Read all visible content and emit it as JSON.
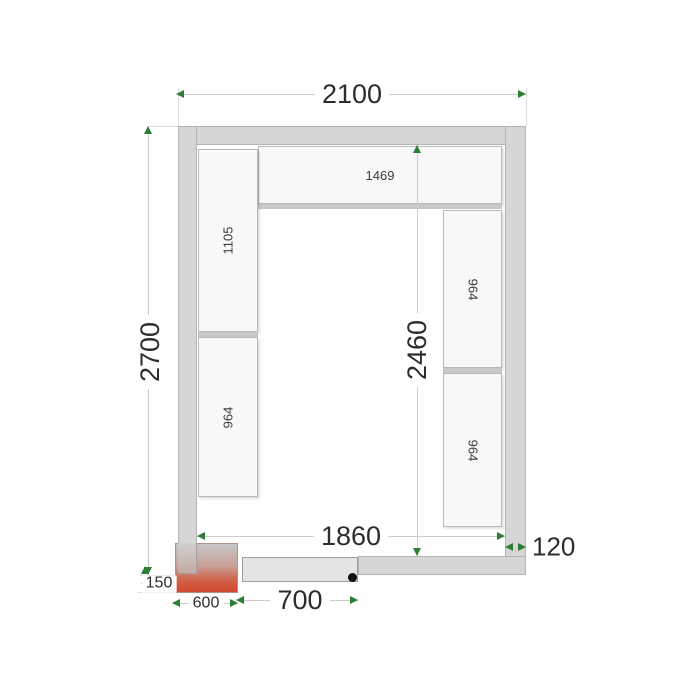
{
  "plan": {
    "dimensions": {
      "outer_width": "2100",
      "outer_height": "2700",
      "inner_width": "1860",
      "inner_height": "2460",
      "wall_thickness": "120",
      "door_width": "700",
      "cooling_unit_width": "600",
      "cooling_unit_offset": "150"
    },
    "shelves": {
      "top": "1469",
      "left_upper": "1105",
      "left_lower": "964",
      "right_upper": "964",
      "right_lower": "964"
    },
    "colors": {
      "wall_fill": "#d6d6d6",
      "shelf_fill": "#f8f8f8",
      "dimension_line": "#cdcdcd",
      "arrow_green": "#2e7d36",
      "unit_red": "#d24b33",
      "door_fill": "#e4e4e4",
      "text": "#2d2d2d"
    }
  }
}
